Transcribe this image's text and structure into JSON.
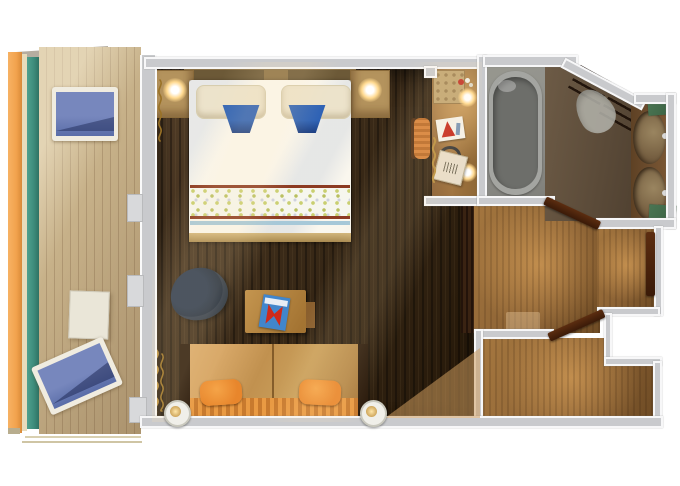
{
  "title": "cruise-stateroom-floor-plan",
  "rooms": [
    {
      "name": "balcony",
      "features": [
        "two-lounge-chairs",
        "side-table",
        "railing",
        "wood-deck"
      ]
    },
    {
      "name": "stateroom",
      "features": [
        "double-bed",
        "two-nightstands",
        "reading-lamps",
        "desk",
        "armchair",
        "sofa-bed",
        "wall-sconces",
        "curtains"
      ]
    },
    {
      "name": "vanity-nook",
      "features": [
        "vanity-counter",
        "stool",
        "two-lamps",
        "sign-card",
        "bag"
      ]
    },
    {
      "name": "bathroom",
      "features": [
        "bathtub",
        "toilet",
        "double-sink-vanity",
        "towel-shelves",
        "green-mats"
      ]
    },
    {
      "name": "entry-hall",
      "features": [
        "entrance-door",
        "bathroom-door",
        "closet-door",
        "closet"
      ]
    }
  ],
  "palette": {
    "wall": "#c9cacd",
    "wall_tab": "#d8d9db",
    "floor_dark": "#3a2a18",
    "floor_dark_hi": "#55402a",
    "floor_darker": "#241708",
    "floor_mid": "#8a6134",
    "floor_mid_hi": "#a5773f",
    "floor_mid_dk": "#6e4b24",
    "floor_mid_glow": "rgba(236,176,98,0.55)",
    "deck": "#c7b189",
    "deck_dark": "#b09873",
    "orange_rail": "#f2a24d",
    "cream_rail": "#e8dcbb",
    "teal_glass": "#3e8d7c",
    "bed_white": "#faf7ee",
    "pillow_cream": "#ece3cb",
    "towel_blue": "#2e62b5",
    "towel_blue_dk": "#1d3f82",
    "band_red": "#8c3a22",
    "band_blue": "#a6c8d8",
    "band_speckle": "#c9cf70",
    "headboard": "#8d7245",
    "nightstand": "#b4935d",
    "lamp_glow": "#ffd98f",
    "sconce_ring": "#f0efe9",
    "sconce_core": "#b98a3a",
    "sofa_back": "#c1914f",
    "sofa_stripe_a": "#e99a43",
    "sofa_stripe_b": "#c87a2e",
    "pillow_orange": "#e8862c",
    "chair_navy": "#1d2836",
    "desk_wood": "#b5854a",
    "mag_blue": "#4186cc",
    "mag_red": "#cf2a1a",
    "vanity_wood": "#a07440",
    "sign_red": "#c4281c",
    "tubroom_gray": "#8e8e8a",
    "tub_rim": "#a4a5a1",
    "tub_basin": "#6d6e6a",
    "bath_floor": "#6d5b46",
    "bath_floor_dk": "#4f4030",
    "toilet_gray": "#b3b3ab",
    "counter_brown": "#6e4e2f",
    "sink": "#70593c",
    "sink_hi": "#9a8560",
    "towel_green": "#3a6142",
    "door_dark": "#3a1a08",
    "door_hi": "#5c2d10",
    "gold": "#b98f3e",
    "gold_dk": "#9a7226",
    "lounger_blue": "#7787bd",
    "lounger_blue_dk": "#5a6da8",
    "lounger_frame": "#f0ece0"
  }
}
